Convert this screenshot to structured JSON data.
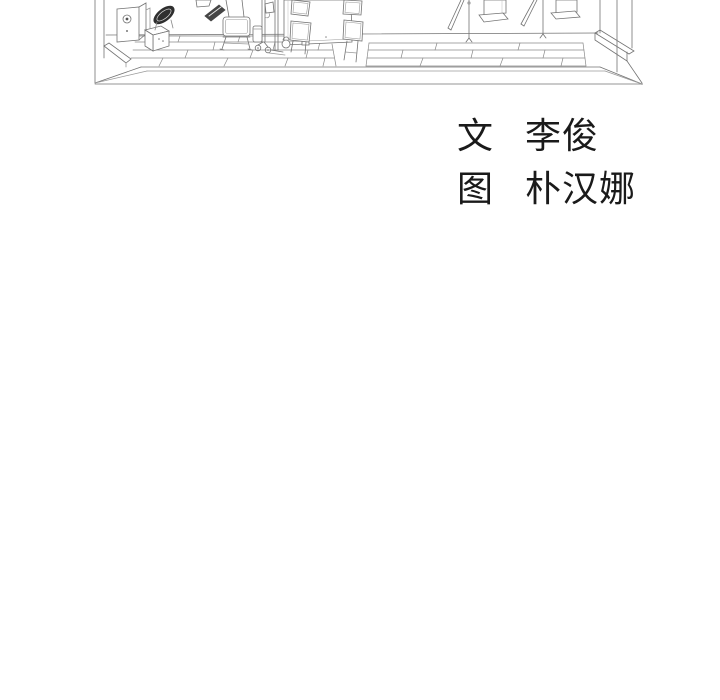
{
  "page": {
    "background": "#ffffff"
  },
  "colors": {
    "ink": "#1a1a1a",
    "line_art": "#737373",
    "line_art_light": "#9a9a9a",
    "dark_fill": "#3a3a3a",
    "background": "#ffffff"
  },
  "credits": {
    "writer": {
      "role": "文",
      "name": "李俊"
    },
    "artist": {
      "role": "图",
      "name": "朴汉娜"
    }
  }
}
